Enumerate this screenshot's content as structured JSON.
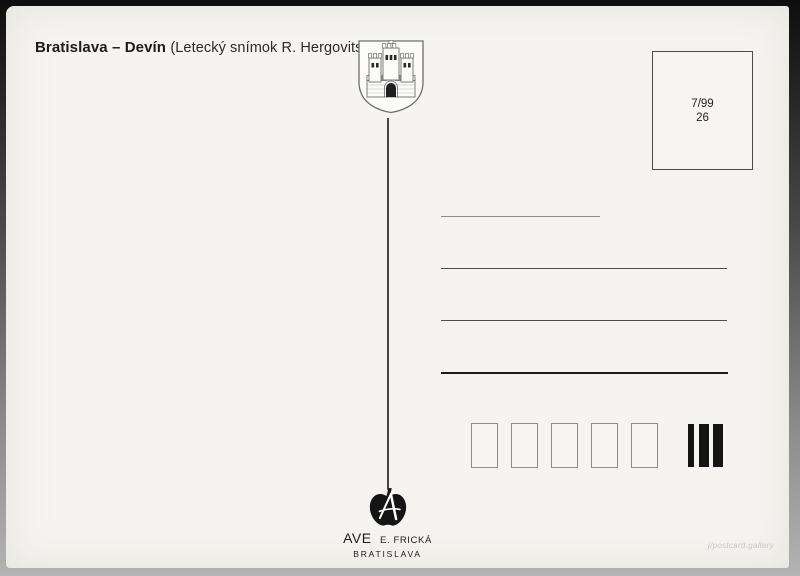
{
  "header": {
    "title_bold": "Bratislava – Devín",
    "title_caption": "(Letecký snímok R. Hergovits)"
  },
  "emblem": {
    "icon": "bratislava-coat-of-arms"
  },
  "stamp_box": {
    "edition": "7/99",
    "number": "26"
  },
  "publisher": {
    "logo_icon": "apple-letter-a",
    "name": "AVE",
    "person": "E. FRICKÁ",
    "city": "BRATISLAVA"
  },
  "watermark": {
    "text": "j/postcard.gallery"
  },
  "colors": {
    "card_bg": "#f5f4f0",
    "ink": "#1c1c1c",
    "line_gray": "#4f4f4f",
    "bar_black": "#141414",
    "watermark_gray": "#c8c8c4"
  }
}
